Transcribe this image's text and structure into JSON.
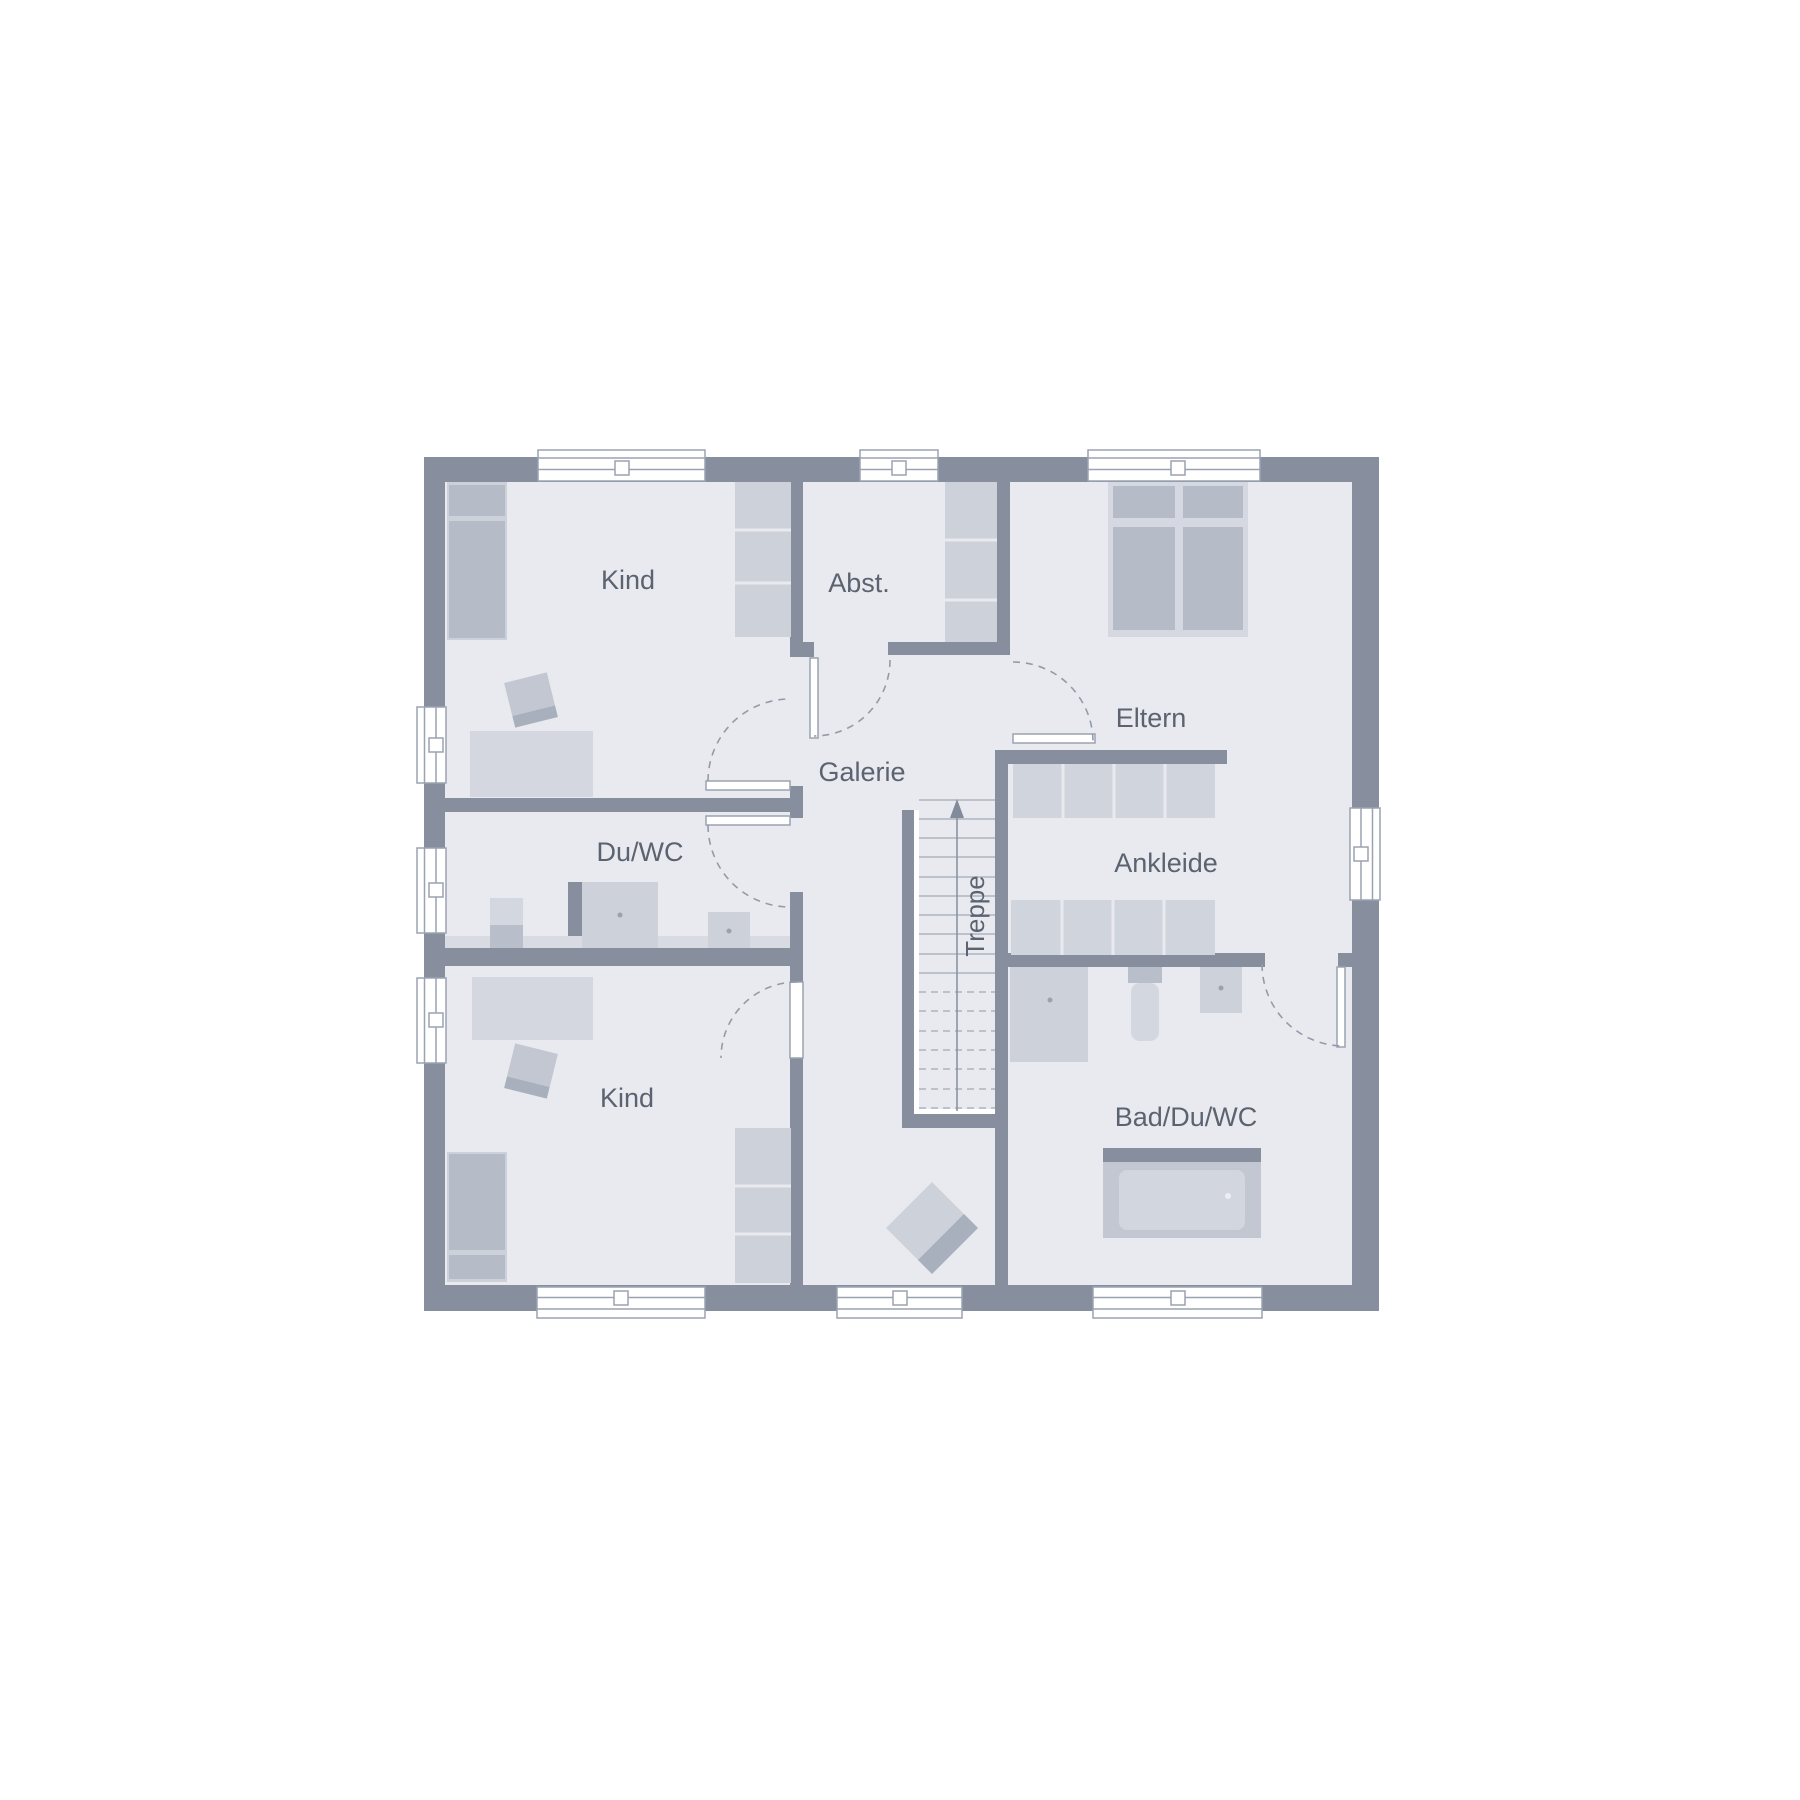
{
  "floor_plan": {
    "type": "architectural-floor-plan",
    "rooms": {
      "kind_top": {
        "label": "Kind"
      },
      "abst": {
        "label": "Abst."
      },
      "eltern": {
        "label": "Eltern"
      },
      "galerie": {
        "label": "Galerie"
      },
      "du_wc": {
        "label": "Du/WC"
      },
      "ankleide": {
        "label": "Ankleide"
      },
      "treppe": {
        "label": "Treppe"
      },
      "kind_bottom": {
        "label": "Kind"
      },
      "bad_du_wc": {
        "label": "Bad/Du/WC"
      }
    },
    "colors": {
      "wall": "#878f9e",
      "floor": "#e8eaef",
      "furniture_light": "#cdd1da",
      "furniture_medium": "#b5bbc7",
      "furniture_pale": "#d4d7df",
      "fixture_dark": "#b9bfca",
      "frame_line": "#9aa3b1",
      "dash_line": "#939baa",
      "stair_line": "#a2aab8",
      "text": "#5b6370",
      "window_fill": "#ffffff",
      "rug_dark": "#a9b0bd"
    }
  }
}
